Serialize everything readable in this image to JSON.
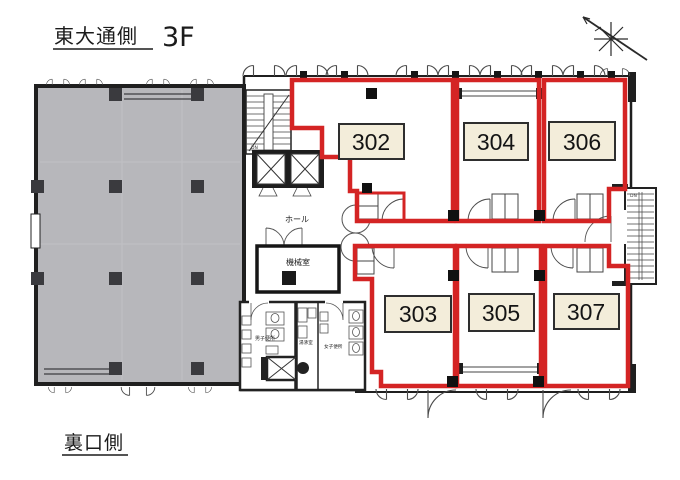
{
  "page": {
    "top_label": "東大通側",
    "floor": "3F",
    "bottom_label": "裏口側"
  },
  "rooms": {
    "top_row": [
      {
        "number": "302"
      },
      {
        "number": "304"
      },
      {
        "number": "306"
      }
    ],
    "bottom_row": [
      {
        "number": "303"
      },
      {
        "number": "305"
      },
      {
        "number": "307"
      }
    ]
  },
  "core_labels": {
    "hall": "ホール",
    "machine_room": "機械室",
    "mens_toilet": "男子便所",
    "kitchenette": "湯沸室",
    "womens_toilet": "女子便所",
    "stair_down": "DN"
  },
  "colors": {
    "unit_outline_red": "#d42424",
    "existing_tenant_gray": "#b7b7bb",
    "room_label_fill": "#f3edda",
    "wall_black": "#1f1f1f"
  }
}
